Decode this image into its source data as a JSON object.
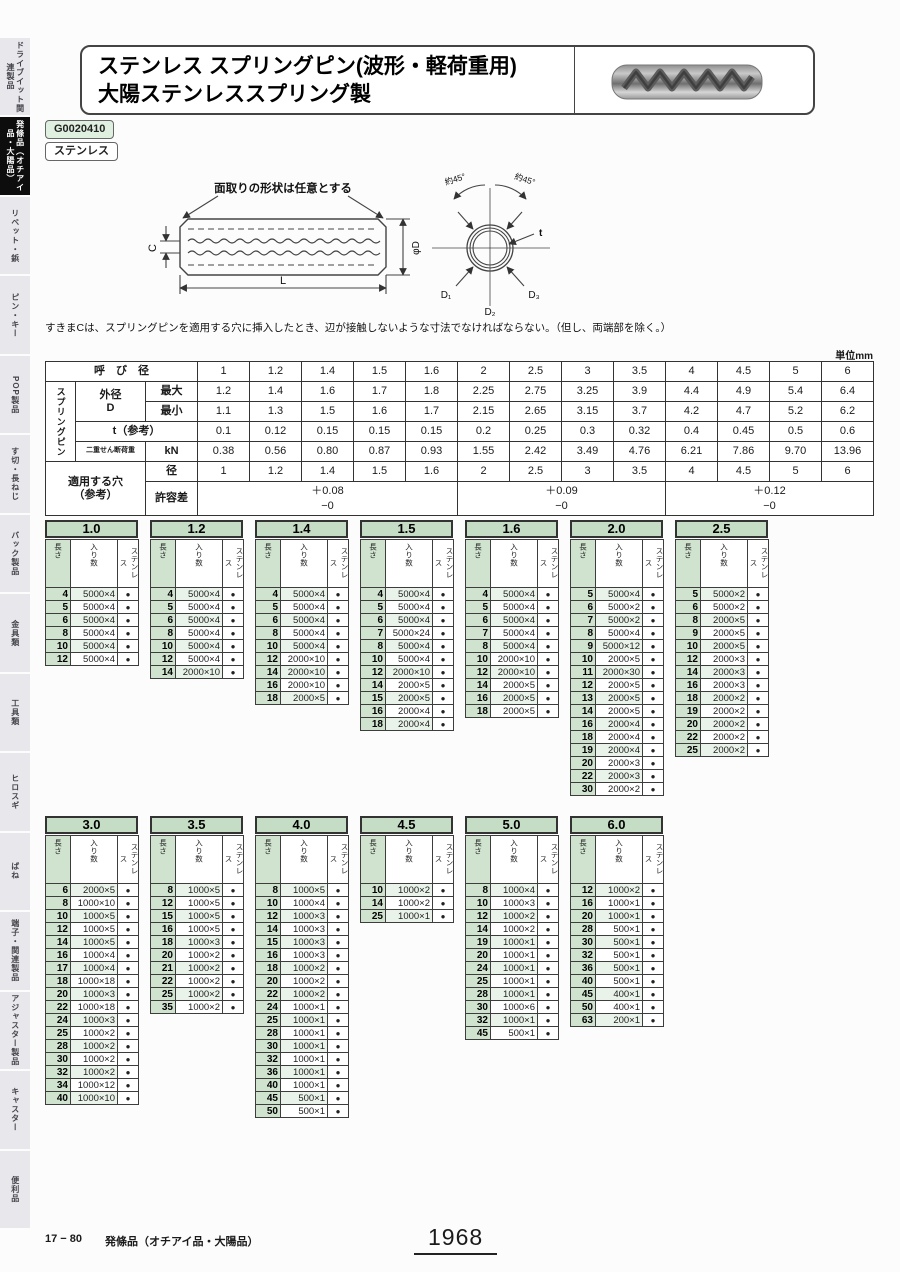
{
  "page": {
    "unit_label": "単位mm",
    "footer_ref": "17 − 80",
    "footer_category": "発條品（オチアイ品・大陽品）",
    "page_number": "1968"
  },
  "sidebar": {
    "items": [
      {
        "label": "ドライブイット関連製品",
        "active": false
      },
      {
        "label": "発條品（オチアイ品・大陽品）",
        "active": true
      },
      {
        "label": "リベット・鋲",
        "active": false
      },
      {
        "label": "ピン・キー",
        "active": false
      },
      {
        "label": "POP製品",
        "active": false
      },
      {
        "label": "す切・長ねじ",
        "active": false
      },
      {
        "label": "バック製品",
        "active": false
      },
      {
        "label": "金具類",
        "active": false
      },
      {
        "label": "工具類",
        "active": false
      },
      {
        "label": "ヒロスギ",
        "active": false
      },
      {
        "label": "ばね",
        "active": false
      },
      {
        "label": "端子・関連製品",
        "active": false
      },
      {
        "label": "アジャスター製品",
        "active": false
      },
      {
        "label": "キャスター",
        "active": false
      },
      {
        "label": "便利品",
        "active": false
      }
    ]
  },
  "header": {
    "title_line1": "ステンレス スプリングピン(波形・軽荷重用)",
    "title_line2": "大陽ステンレススプリング製",
    "code": "G0020410",
    "material": "ステンレス"
  },
  "diagram": {
    "chamfer_note": "面取りの形状は任意とする",
    "label_c": "C",
    "label_l": "L",
    "label_d": "φD",
    "angle_left": "約45°",
    "angle_right": "約45°",
    "label_t": "t",
    "label_d1": "D₁",
    "label_d2": "D₂",
    "label_d3": "D₃",
    "note": "すきまCは、スプリングピンを適用する穴に挿入したとき、辺が接触しないような寸法でなければならない。（但し、両端部を除く。）"
  },
  "spec_table": {
    "labels": {
      "nominal": "呼　び　径",
      "group": "スプリングピン",
      "od": "外径\nD",
      "max": "最大",
      "min": "最小",
      "t": "t（参考）",
      "shear": "二重せん断荷重",
      "kn": "kN",
      "hole": "適用する穴\n（参考）",
      "dia": "径",
      "tol": "許容差"
    },
    "diameters": [
      "1",
      "1.2",
      "1.4",
      "1.5",
      "1.6",
      "2",
      "2.5",
      "3",
      "3.5",
      "4",
      "4.5",
      "5",
      "6"
    ],
    "od_max": [
      "1.2",
      "1.4",
      "1.6",
      "1.7",
      "1.8",
      "2.25",
      "2.75",
      "3.25",
      "3.9",
      "4.4",
      "4.9",
      "5.4",
      "6.4"
    ],
    "od_min": [
      "1.1",
      "1.3",
      "1.5",
      "1.6",
      "1.7",
      "2.15",
      "2.65",
      "3.15",
      "3.7",
      "4.2",
      "4.7",
      "5.2",
      "6.2"
    ],
    "t_ref": [
      "0.1",
      "0.12",
      "0.15",
      "0.15",
      "0.15",
      "0.2",
      "0.25",
      "0.3",
      "0.32",
      "0.4",
      "0.45",
      "0.5",
      "0.6"
    ],
    "shear": [
      "0.38",
      "0.56",
      "0.80",
      "0.87",
      "0.93",
      "1.55",
      "2.42",
      "3.49",
      "4.76",
      "6.21",
      "7.86",
      "9.70",
      "13.96"
    ],
    "hole_dia": [
      "1",
      "1.2",
      "1.4",
      "1.5",
      "1.6",
      "2",
      "2.5",
      "3",
      "3.5",
      "4",
      "4.5",
      "5",
      "6"
    ],
    "tolerance_groups": [
      {
        "plus": "＋0.08",
        "minus": "−0",
        "span": 5
      },
      {
        "plus": "＋0.09",
        "minus": "−0",
        "span": 4
      },
      {
        "plus": "＋0.12",
        "minus": "−0",
        "span": 4
      }
    ]
  },
  "size_tables": {
    "columns": [
      "長さ",
      "入り数",
      "ステンレス"
    ],
    "dot": "●",
    "row1": [
      {
        "title": "1.0",
        "rows": [
          [
            "4",
            "5000×4"
          ],
          [
            "5",
            "5000×4"
          ],
          [
            "6",
            "5000×4"
          ],
          [
            "8",
            "5000×4"
          ],
          [
            "10",
            "5000×4"
          ],
          [
            "12",
            "5000×4"
          ]
        ]
      },
      {
        "title": "1.2",
        "rows": [
          [
            "4",
            "5000×4"
          ],
          [
            "5",
            "5000×4"
          ],
          [
            "6",
            "5000×4"
          ],
          [
            "8",
            "5000×4"
          ],
          [
            "10",
            "5000×4"
          ],
          [
            "12",
            "5000×4"
          ],
          [
            "14",
            "2000×10"
          ]
        ]
      },
      {
        "title": "1.4",
        "rows": [
          [
            "4",
            "5000×4"
          ],
          [
            "5",
            "5000×4"
          ],
          [
            "6",
            "5000×4"
          ],
          [
            "8",
            "5000×4"
          ],
          [
            "10",
            "5000×4"
          ],
          [
            "12",
            "2000×10"
          ],
          [
            "14",
            "2000×10"
          ],
          [
            "16",
            "2000×10"
          ],
          [
            "18",
            "2000×5"
          ]
        ]
      },
      {
        "title": "1.5",
        "rows": [
          [
            "4",
            "5000×4"
          ],
          [
            "5",
            "5000×4"
          ],
          [
            "6",
            "5000×4"
          ],
          [
            "7",
            "5000×24"
          ],
          [
            "8",
            "5000×4"
          ],
          [
            "10",
            "5000×4"
          ],
          [
            "12",
            "2000×10"
          ],
          [
            "14",
            "2000×5"
          ],
          [
            "15",
            "2000×5"
          ],
          [
            "16",
            "2000×4"
          ],
          [
            "18",
            "2000×4"
          ]
        ]
      },
      {
        "title": "1.6",
        "rows": [
          [
            "4",
            "5000×4"
          ],
          [
            "5",
            "5000×4"
          ],
          [
            "6",
            "5000×4"
          ],
          [
            "7",
            "5000×4"
          ],
          [
            "8",
            "5000×4"
          ],
          [
            "10",
            "2000×10"
          ],
          [
            "12",
            "2000×10"
          ],
          [
            "14",
            "2000×5"
          ],
          [
            "16",
            "2000×5"
          ],
          [
            "18",
            "2000×5"
          ]
        ]
      },
      {
        "title": "2.0",
        "rows": [
          [
            "5",
            "5000×4"
          ],
          [
            "6",
            "5000×2"
          ],
          [
            "7",
            "5000×2"
          ],
          [
            "8",
            "5000×4"
          ],
          [
            "9",
            "5000×12"
          ],
          [
            "10",
            "2000×5"
          ],
          [
            "11",
            "2000×30"
          ],
          [
            "12",
            "2000×5"
          ],
          [
            "13",
            "2000×5"
          ],
          [
            "14",
            "2000×5"
          ],
          [
            "16",
            "2000×4"
          ],
          [
            "18",
            "2000×4"
          ],
          [
            "19",
            "2000×4"
          ],
          [
            "20",
            "2000×3"
          ],
          [
            "22",
            "2000×3"
          ],
          [
            "30",
            "2000×2"
          ]
        ]
      },
      {
        "title": "2.5",
        "rows": [
          [
            "5",
            "5000×2"
          ],
          [
            "6",
            "5000×2"
          ],
          [
            "8",
            "2000×5"
          ],
          [
            "9",
            "2000×5"
          ],
          [
            "10",
            "2000×5"
          ],
          [
            "12",
            "2000×3"
          ],
          [
            "14",
            "2000×3"
          ],
          [
            "16",
            "2000×3"
          ],
          [
            "18",
            "2000×2"
          ],
          [
            "19",
            "2000×2"
          ],
          [
            "20",
            "2000×2"
          ],
          [
            "22",
            "2000×2"
          ],
          [
            "25",
            "2000×2"
          ]
        ]
      }
    ],
    "row2": [
      {
        "title": "3.0",
        "rows": [
          [
            "6",
            "2000×5"
          ],
          [
            "8",
            "1000×10"
          ],
          [
            "10",
            "1000×5"
          ],
          [
            "12",
            "1000×5"
          ],
          [
            "14",
            "1000×5"
          ],
          [
            "16",
            "1000×4"
          ],
          [
            "17",
            "1000×4"
          ],
          [
            "18",
            "1000×18"
          ],
          [
            "20",
            "1000×3"
          ],
          [
            "22",
            "1000×18"
          ],
          [
            "24",
            "1000×3"
          ],
          [
            "25",
            "1000×2"
          ],
          [
            "28",
            "1000×2"
          ],
          [
            "30",
            "1000×2"
          ],
          [
            "32",
            "1000×2"
          ],
          [
            "34",
            "1000×12"
          ],
          [
            "40",
            "1000×10"
          ]
        ]
      },
      {
        "title": "3.5",
        "rows": [
          [
            "8",
            "1000×5"
          ],
          [
            "12",
            "1000×5"
          ],
          [
            "15",
            "1000×5"
          ],
          [
            "16",
            "1000×5"
          ],
          [
            "18",
            "1000×3"
          ],
          [
            "20",
            "1000×2"
          ],
          [
            "21",
            "1000×2"
          ],
          [
            "22",
            "1000×2"
          ],
          [
            "25",
            "1000×2"
          ],
          [
            "35",
            "1000×2"
          ]
        ]
      },
      {
        "title": "4.0",
        "rows": [
          [
            "8",
            "1000×5"
          ],
          [
            "10",
            "1000×4"
          ],
          [
            "12",
            "1000×3"
          ],
          [
            "14",
            "1000×3"
          ],
          [
            "15",
            "1000×3"
          ],
          [
            "16",
            "1000×3"
          ],
          [
            "18",
            "1000×2"
          ],
          [
            "20",
            "1000×2"
          ],
          [
            "22",
            "1000×2"
          ],
          [
            "24",
            "1000×1"
          ],
          [
            "25",
            "1000×1"
          ],
          [
            "28",
            "1000×1"
          ],
          [
            "30",
            "1000×1"
          ],
          [
            "32",
            "1000×1"
          ],
          [
            "36",
            "1000×1"
          ],
          [
            "40",
            "1000×1"
          ],
          [
            "45",
            "500×1"
          ],
          [
            "50",
            "500×1"
          ]
        ]
      },
      {
        "title": "4.5",
        "rows": [
          [
            "10",
            "1000×2"
          ],
          [
            "14",
            "1000×2"
          ],
          [
            "25",
            "1000×1"
          ]
        ]
      },
      {
        "title": "5.0",
        "rows": [
          [
            "8",
            "1000×4"
          ],
          [
            "10",
            "1000×3"
          ],
          [
            "12",
            "1000×2"
          ],
          [
            "14",
            "1000×2"
          ],
          [
            "19",
            "1000×1"
          ],
          [
            "20",
            "1000×1"
          ],
          [
            "24",
            "1000×1"
          ],
          [
            "25",
            "1000×1"
          ],
          [
            "28",
            "1000×1"
          ],
          [
            "30",
            "1000×6"
          ],
          [
            "32",
            "1000×1"
          ],
          [
            "45",
            "500×1"
          ]
        ]
      },
      {
        "title": "6.0",
        "rows": [
          [
            "12",
            "1000×2"
          ],
          [
            "16",
            "1000×1"
          ],
          [
            "20",
            "1000×1"
          ],
          [
            "28",
            "500×1"
          ],
          [
            "30",
            "500×1"
          ],
          [
            "32",
            "500×1"
          ],
          [
            "36",
            "500×1"
          ],
          [
            "40",
            "500×1"
          ],
          [
            "45",
            "400×1"
          ],
          [
            "50",
            "400×1"
          ],
          [
            "63",
            "200×1"
          ]
        ]
      }
    ]
  }
}
